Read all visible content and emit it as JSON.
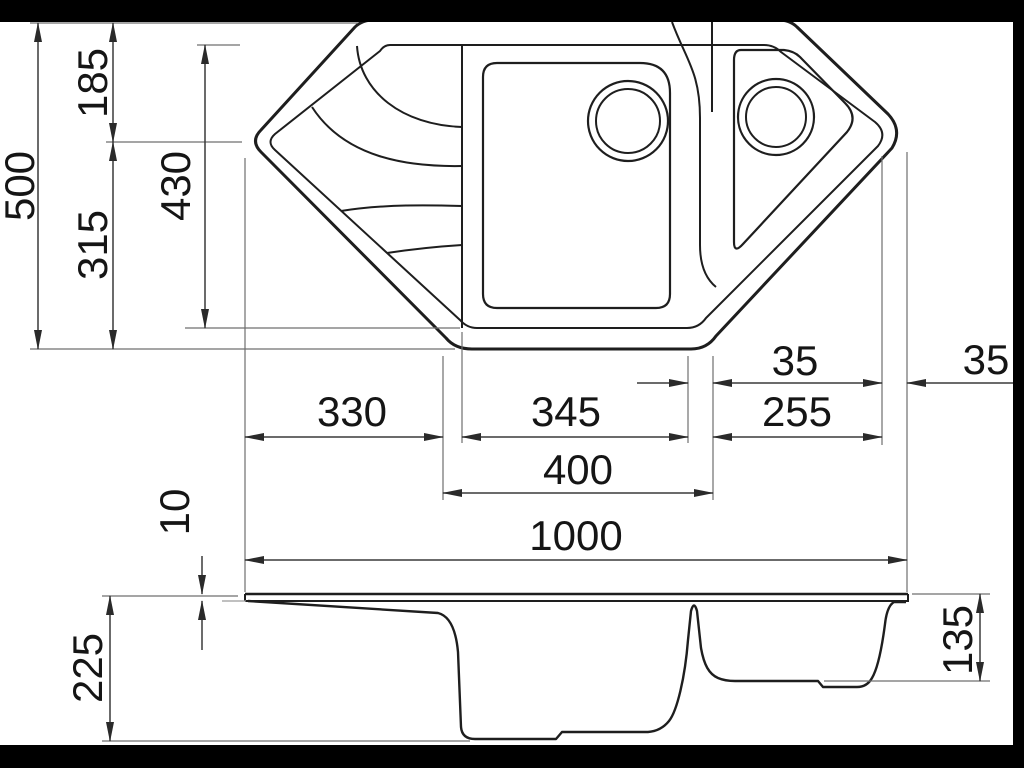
{
  "drawing": {
    "type": "technical-dimension-drawing",
    "subject": "corner kitchen sink, plan view and section view",
    "units": "mm",
    "colors": {
      "background": "#ffffff",
      "line": "#1e1e1e",
      "dimension_line": "#3a3a3a",
      "extension_line": "#6f6f6f",
      "text": "#151515",
      "letterbox": "#000000"
    }
  },
  "plan": {
    "overall_depth": "500",
    "top_offset": "185",
    "lower_offset": "315",
    "opening_depth": "430",
    "drainer_width": "330",
    "bowl_inner_width": "345",
    "corner_section_width": "255",
    "rim_gap_inner": "35",
    "rim_gap_outer": "35",
    "bowl_outer_width": "400",
    "overall_width": "1000"
  },
  "side": {
    "rim_thickness": "10",
    "main_bowl_depth": "225",
    "corner_bowl_depth": "135"
  }
}
